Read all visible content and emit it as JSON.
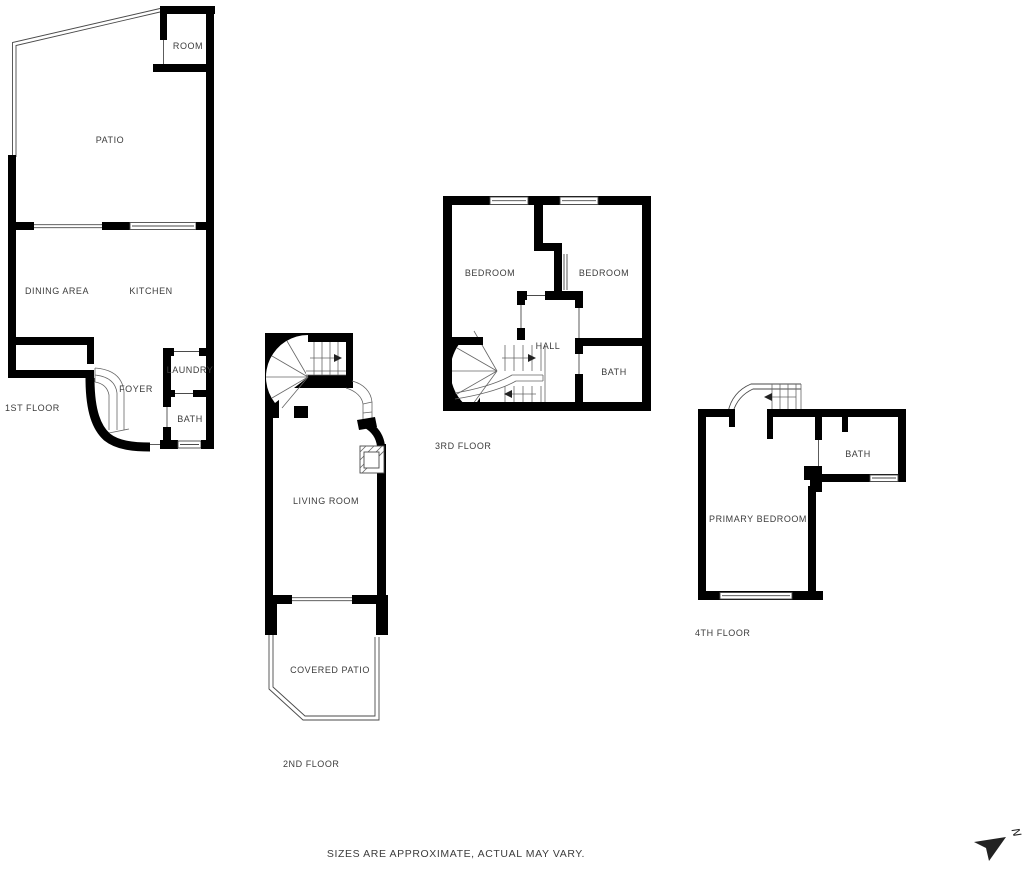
{
  "floors": {
    "first": {
      "label": "1ST FLOOR",
      "rooms": {
        "room": "ROOM",
        "patio": "PATIO",
        "dining": "DINING AREA",
        "kitchen": "KITCHEN",
        "laundry": "LAUNDRY",
        "foyer": "FOYER",
        "bath": "BATH"
      }
    },
    "second": {
      "label": "2ND FLOOR",
      "rooms": {
        "living": "LIVING ROOM",
        "covered_patio": "COVERED PATIO"
      }
    },
    "third": {
      "label": "3RD FLOOR",
      "rooms": {
        "bedroom_left": "BEDROOM",
        "bedroom_right": "BEDROOM",
        "hall": "HALL",
        "bath": "BATH"
      }
    },
    "fourth": {
      "label": "4TH FLOOR",
      "rooms": {
        "primary_bedroom": "PRIMARY BEDROOM",
        "bath": "BATH"
      }
    }
  },
  "footer": {
    "disclaimer": "SIZES ARE APPROXIMATE, ACTUAL MAY VARY."
  },
  "compass": {
    "north_label": "N"
  },
  "colors": {
    "wall": "#000000",
    "thin_line": "#4a4a4a",
    "stair_line": "#666666",
    "label_text": "#3c3c3c",
    "background": "#ffffff"
  }
}
